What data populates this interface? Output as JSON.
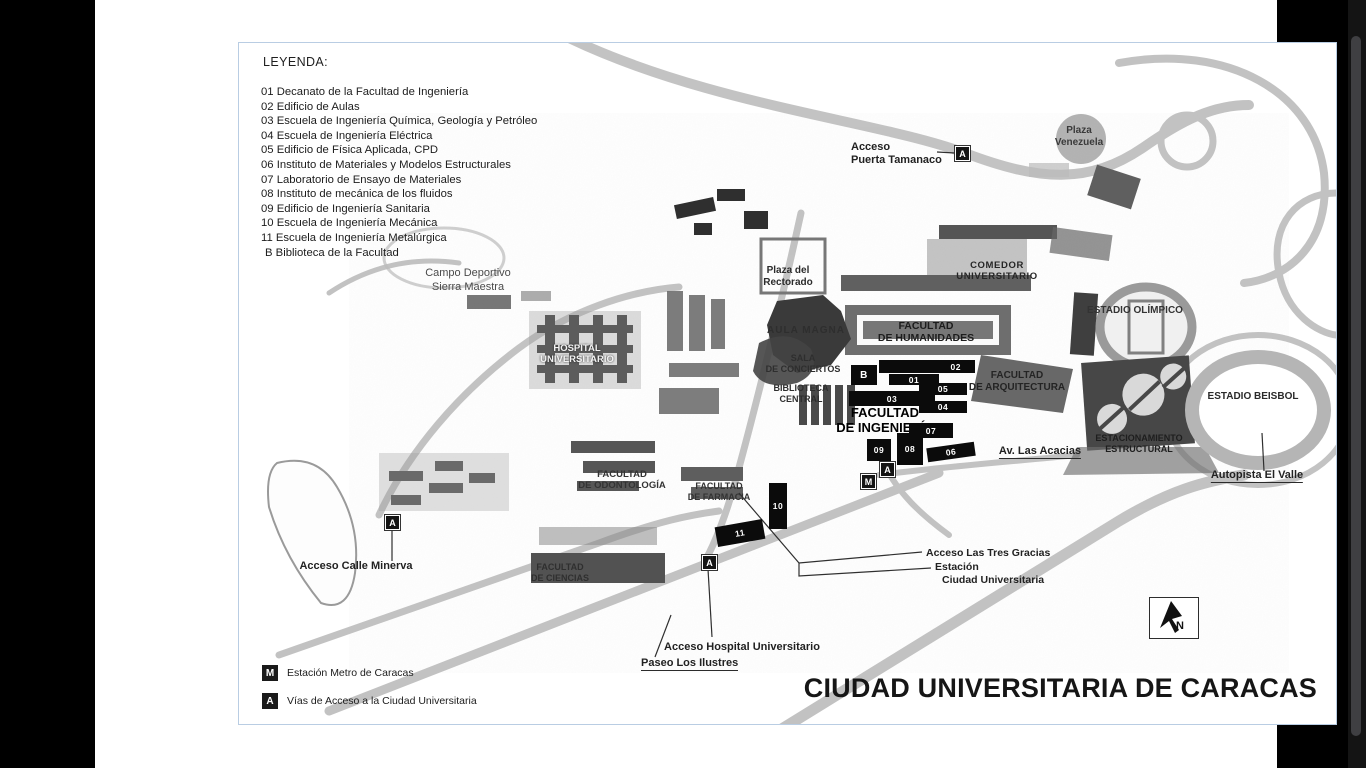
{
  "colors": {
    "page_border": "#b9cde3",
    "marker_bg": "#141414",
    "building_fill": "#0b0b0b",
    "road_gray": "#b8b8b8"
  },
  "legend": {
    "title": "LEYENDA:",
    "items": [
      "01 Decanato de la Facultad de Ingeniería",
      "02 Edificio de Aulas",
      "03 Escuela de Ingeniería Química, Geología y Petróleo",
      "04 Escuela de Ingeniería Eléctrica",
      "05 Edificio de Física Aplicada, CPD",
      "06 Instituto de Materiales y Modelos Estructurales",
      "07 Laboratorio de Ensayo de Materiales",
      "08 Instituto de mecánica de los fluidos",
      "09 Edificio de Ingeniería Sanitaria",
      "10 Escuela de Ingeniería Mecánica",
      "11 Escuela de Ingeniería Metalúrgica",
      "B Biblioteca de la Facultad"
    ]
  },
  "map_key": {
    "items": [
      {
        "symbol": "M",
        "text": "Estación Metro de Caracas"
      },
      {
        "symbol": "A",
        "text": "Vías de Acceso a la Ciudad Universitaria"
      }
    ]
  },
  "markers": {
    "access": "A",
    "metro": "M"
  },
  "buildings": [
    "B",
    "02",
    "01",
    "05",
    "03",
    "04",
    "07",
    "09",
    "08",
    "06",
    "10",
    "11"
  ],
  "labels": {
    "acceso_puerta_tamanaco": {
      "l1": "Acceso",
      "l2": "Puerta Tamanaco"
    },
    "plaza_venezuela": {
      "l1": "Plaza",
      "l2": "Venezuela"
    },
    "comedor_universitario": {
      "l1": "COMEDOR",
      "l2": "UNIVERSITARIO"
    },
    "plaza_rectorado": {
      "l1": "Plaza del",
      "l2": "Rectorado"
    },
    "aula_magna": {
      "l1": "AULA MAGNA"
    },
    "sala_conciertos": {
      "l1": "SALA",
      "l2": "DE CONCIERTOS"
    },
    "biblioteca_central": {
      "l1": "BIBLIOTECA",
      "l2": "CENTRAL"
    },
    "facultad_humanidades": {
      "l1": "FACULTAD",
      "l2": "DE HUMANIDADES"
    },
    "facultad_arquitectura": {
      "l1": "FACULTAD",
      "l2": "DE ARQUITECTURA"
    },
    "facultad_ingenieria": {
      "l1": "FACULTAD",
      "l2": "DE INGENIERÍA"
    },
    "estadio_olimpico": {
      "l1": "ESTADIO OLÍMPICO"
    },
    "estadio_beisbol": {
      "l1": "ESTADIO BEISBOL"
    },
    "estacionamiento_estructural": {
      "l1": "ESTACIONAMIENTO",
      "l2": "ESTRUCTURAL"
    },
    "autopista_el_valle": {
      "l1": "Autopista El Valle"
    },
    "av_las_acacias": {
      "l1": "Av. Las Acacias"
    },
    "campo_deportivo": {
      "l1": "Campo Deportivo",
      "l2": "Sierra Maestra"
    },
    "hospital_universitario": {
      "l1": "HOSPITAL",
      "l2": "UNIVERSITARIO"
    },
    "facultad_odontologia": {
      "l1": "FACULTAD",
      "l2": "DE ODONTOLOGÍA"
    },
    "facultad_farmacia": {
      "l1": "FACULTAD",
      "l2": "DE FARMACIA"
    },
    "facultad_ciencias": {
      "l1": "FACULTAD",
      "l2": "DE CIENCIAS"
    },
    "acceso_calle_minerva": {
      "l1": "Acceso Calle Minerva"
    },
    "acceso_tres_gracias": {
      "l1": "Acceso Las Tres Gracias"
    },
    "estacion_cu": {
      "l1": "Estación",
      "l2": "Ciudad Universitaria"
    },
    "acceso_hospital": {
      "l1": "Acceso Hospital Universitario"
    },
    "paseo_ilustres": {
      "l1": "Paseo Los Ilustres"
    }
  },
  "north": {
    "label": "N"
  },
  "title": "CIUDAD UNIVERSITARIA DE CARACAS"
}
